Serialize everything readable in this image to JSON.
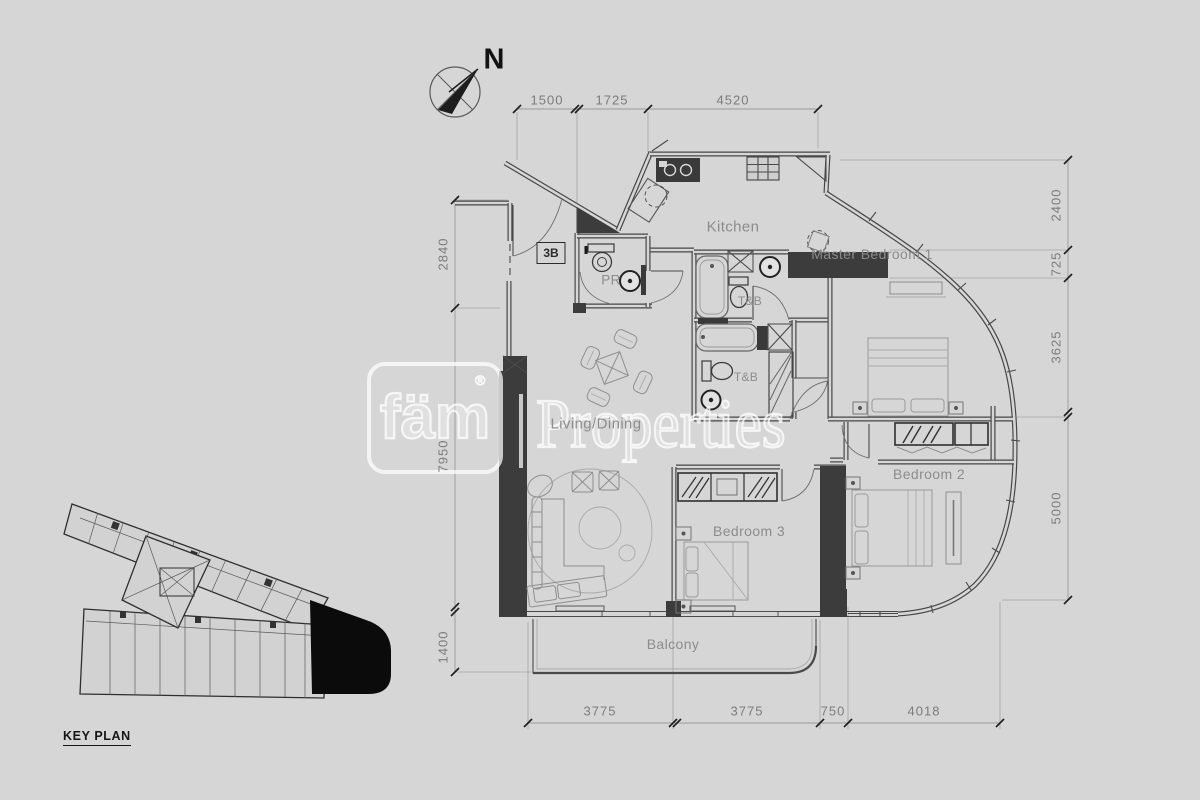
{
  "north": {
    "label": "N"
  },
  "unit_tag": "3B",
  "rooms": {
    "kitchen": "Kitchen",
    "pr": "PR",
    "tb_upper": "T&B",
    "tb_lower": "T&B",
    "master_bedroom": "Master Bedroom 1",
    "bedroom2": "Bedroom 2",
    "bedroom3": "Bedroom 3",
    "living_dining": "Living/Dining",
    "balcony": "Balcony"
  },
  "watermark": {
    "brand": "fäm",
    "registered": "®",
    "name": "Properties"
  },
  "key_plan": {
    "label": "KEY PLAN"
  },
  "dimensions": {
    "top": [
      "1500",
      "1725",
      "4520"
    ],
    "left": [
      "2840",
      "7950",
      "1400"
    ],
    "right": [
      "2400",
      "725",
      "3625",
      "5000"
    ],
    "bottom": [
      "3775",
      "3775",
      "750",
      "4018"
    ]
  }
}
